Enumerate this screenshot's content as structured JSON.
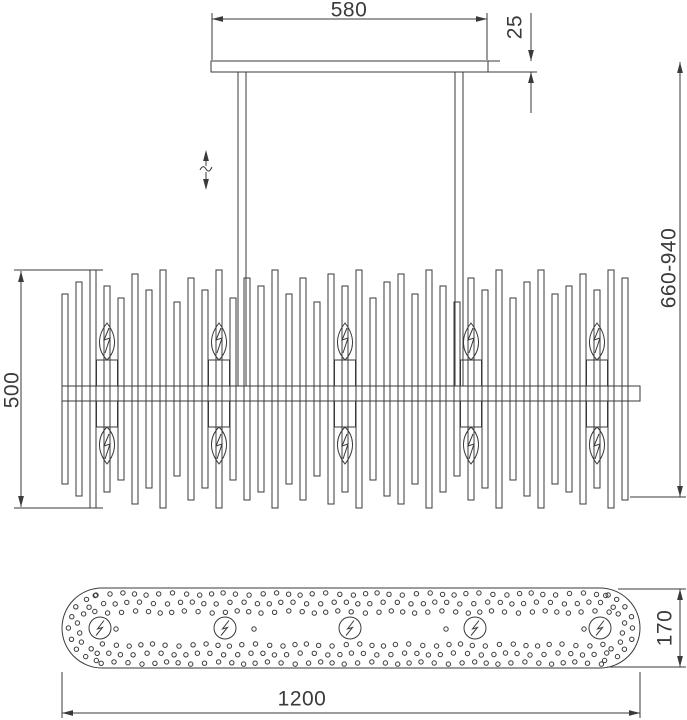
{
  "meta": {
    "description": "Technical dimension drawing of a linear chandelier: ceiling canopy side view, shade side view with candle bulbs, and base plate bottom view",
    "background_color": "#ffffff",
    "line_color": "#3a3a3a"
  },
  "dimensions": {
    "canopy_width": "580",
    "canopy_thickness": "25",
    "shade_height": "500",
    "overall_height": "660-940",
    "base_height": "170",
    "base_width": "1200"
  },
  "figure": {
    "canopy": {
      "x": 211,
      "y": 61,
      "w": 277,
      "h": 11
    },
    "hang_rods": {
      "xs": [
        238,
        455
      ],
      "w": 8,
      "y1": 72,
      "y2": 386
    },
    "adjust_arrow": {
      "x": 206,
      "tip_top": 150,
      "tip_bottom": 190,
      "gap1": 166,
      "gap2": 172
    },
    "shade": {
      "rod_x0": 62,
      "rod_step": 14,
      "rod_w": 6,
      "center_y": 389,
      "half_heights": [
        95,
        107,
        119,
        103,
        91,
        115,
        99,
        119,
        87,
        111,
        99,
        119,
        91,
        111,
        103,
        119,
        95,
        111,
        87,
        115,
        103,
        119,
        91,
        107,
        115,
        95,
        119,
        103,
        87,
        111,
        99,
        119,
        91,
        107,
        119,
        95,
        103,
        115,
        99,
        119,
        111
      ],
      "bar": {
        "x": 62,
        "y": 386,
        "w": 578,
        "h": 15
      }
    },
    "bulbs": {
      "cx": [
        107,
        219,
        345,
        471,
        597
      ],
      "holder_w": 21,
      "holder_h": 26,
      "upper_holder_y": 360,
      "lower_holder_y": 401,
      "upper_flame_tip": 323,
      "upper_flame_base": 360,
      "lower_flame_tip": 464,
      "lower_flame_base": 427,
      "flame_rx": 11
    },
    "base": {
      "x": 62,
      "y": 588,
      "w": 578,
      "h": 80,
      "rx": 40,
      "rows_y": [
        594,
        603,
        612,
        645,
        654,
        663
      ],
      "row_x1": 96,
      "row_x2": 608,
      "hole_step": 12.8,
      "hole_r": 2.2,
      "cap_centers": [
        102,
        600
      ],
      "cap_r1": 33,
      "cap_r2": 24,
      "cap_cy": 628,
      "mid_holes_x": [
        116,
        254,
        446,
        584
      ],
      "sockets": [
        100,
        225,
        350,
        475,
        600
      ],
      "socket_cy": 628,
      "socket_r": 11
    },
    "dims": {
      "d580": {
        "x1": 212,
        "x2": 487,
        "y": 19,
        "ext_top": 13,
        "obj_y": 60
      },
      "d25": {
        "x": 531,
        "tip1": 61,
        "tip2": 72,
        "top": 13,
        "bottom": 113,
        "ext1": [
          488,
          61,
          500
        ],
        "ext2": [
          488,
          72,
          537
        ]
      },
      "d500": {
        "x": 21,
        "tip1": 271,
        "tip2": 507,
        "ext_x1": 14,
        "ext_x2": 103,
        "ext_y1": 270,
        "ext_y2": 508
      },
      "d660": {
        "x": 680,
        "tip1": 62,
        "tip2": 497,
        "ext": [
          630,
          686,
          497
        ]
      },
      "d170": {
        "x": 680,
        "tip1": 589,
        "tip2": 667,
        "ext_top": [
          618,
          686,
          589
        ],
        "ext_bot": [
          607,
          686,
          667
        ]
      },
      "d1200": {
        "y": 713,
        "x1": 62,
        "x2": 640,
        "ext_y1": 672,
        "ext_y2": 718
      }
    }
  }
}
